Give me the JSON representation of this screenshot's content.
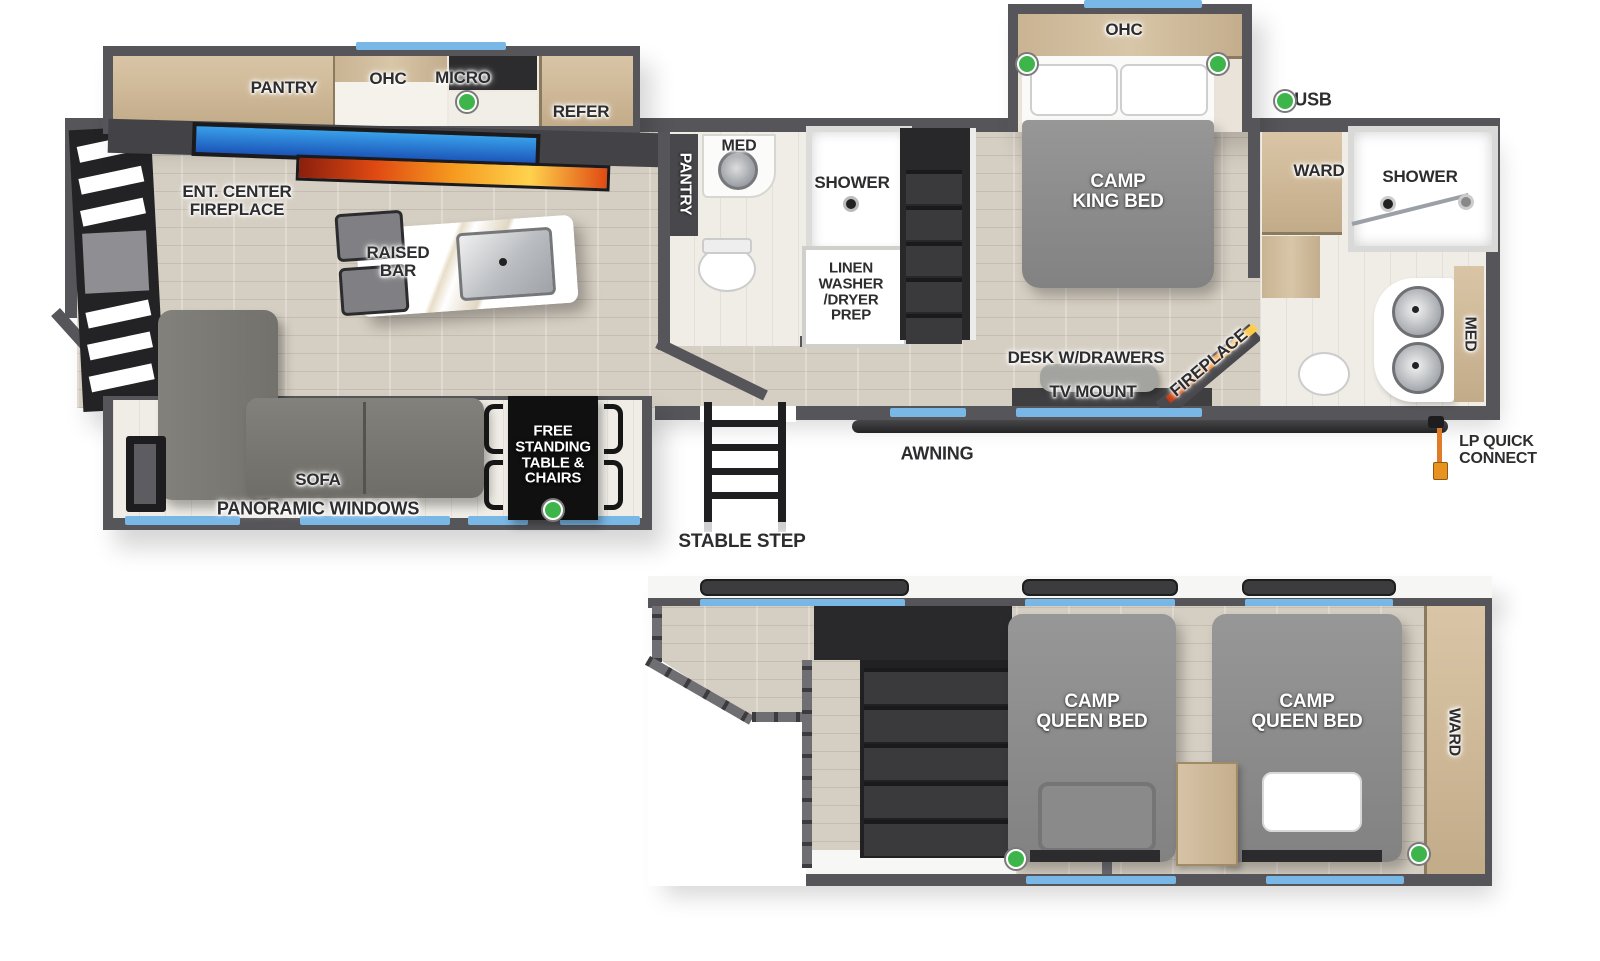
{
  "legend": {
    "usb": "USB"
  },
  "colors": {
    "usb_green": "#3db54a",
    "window_blue": "#79b7e6",
    "lp_orange": "#e8921f",
    "fireplace_orange": "#f59a1f",
    "tv_blue": "#2e8fe0",
    "wall_gray": "#56565a"
  },
  "main_floor": {
    "kitchen": {
      "pantry": "PANTRY",
      "ohc": "OHC",
      "micro": "MICRO",
      "refer": "REFER"
    },
    "living": {
      "ent_center": "ENT. CENTER\nFIREPLACE",
      "raised_bar": "RAISED\nBAR",
      "sofa": "SOFA",
      "panoramic_windows": "PANORAMIC WINDOWS",
      "dinette": "FREE\nSTANDING\nTABLE &\nCHAIRS"
    },
    "mid_bath": {
      "pantry": "PANTRY",
      "med": "MED",
      "shower": "SHOWER",
      "linen": "LINEN\nWASHER\n/DRYER\nPREP"
    },
    "bedroom": {
      "ohc": "OHC",
      "bed": "CAMP\nKING BED",
      "desk": "DESK W/DRAWERS",
      "tv_mount": "TV MOUNT",
      "fireplace": "FIREPLACE",
      "ward": "WARD"
    },
    "rear_bath": {
      "shower": "SHOWER",
      "med": "MED"
    },
    "exterior": {
      "awning": "AWNING",
      "stable_step": "STABLE STEP",
      "lp_quick_connect": "LP QUICK\nCONNECT"
    }
  },
  "loft": {
    "bed_left": "CAMP\nQUEEN BED",
    "bed_right": "CAMP\nQUEEN BED",
    "ward": "WARD"
  }
}
